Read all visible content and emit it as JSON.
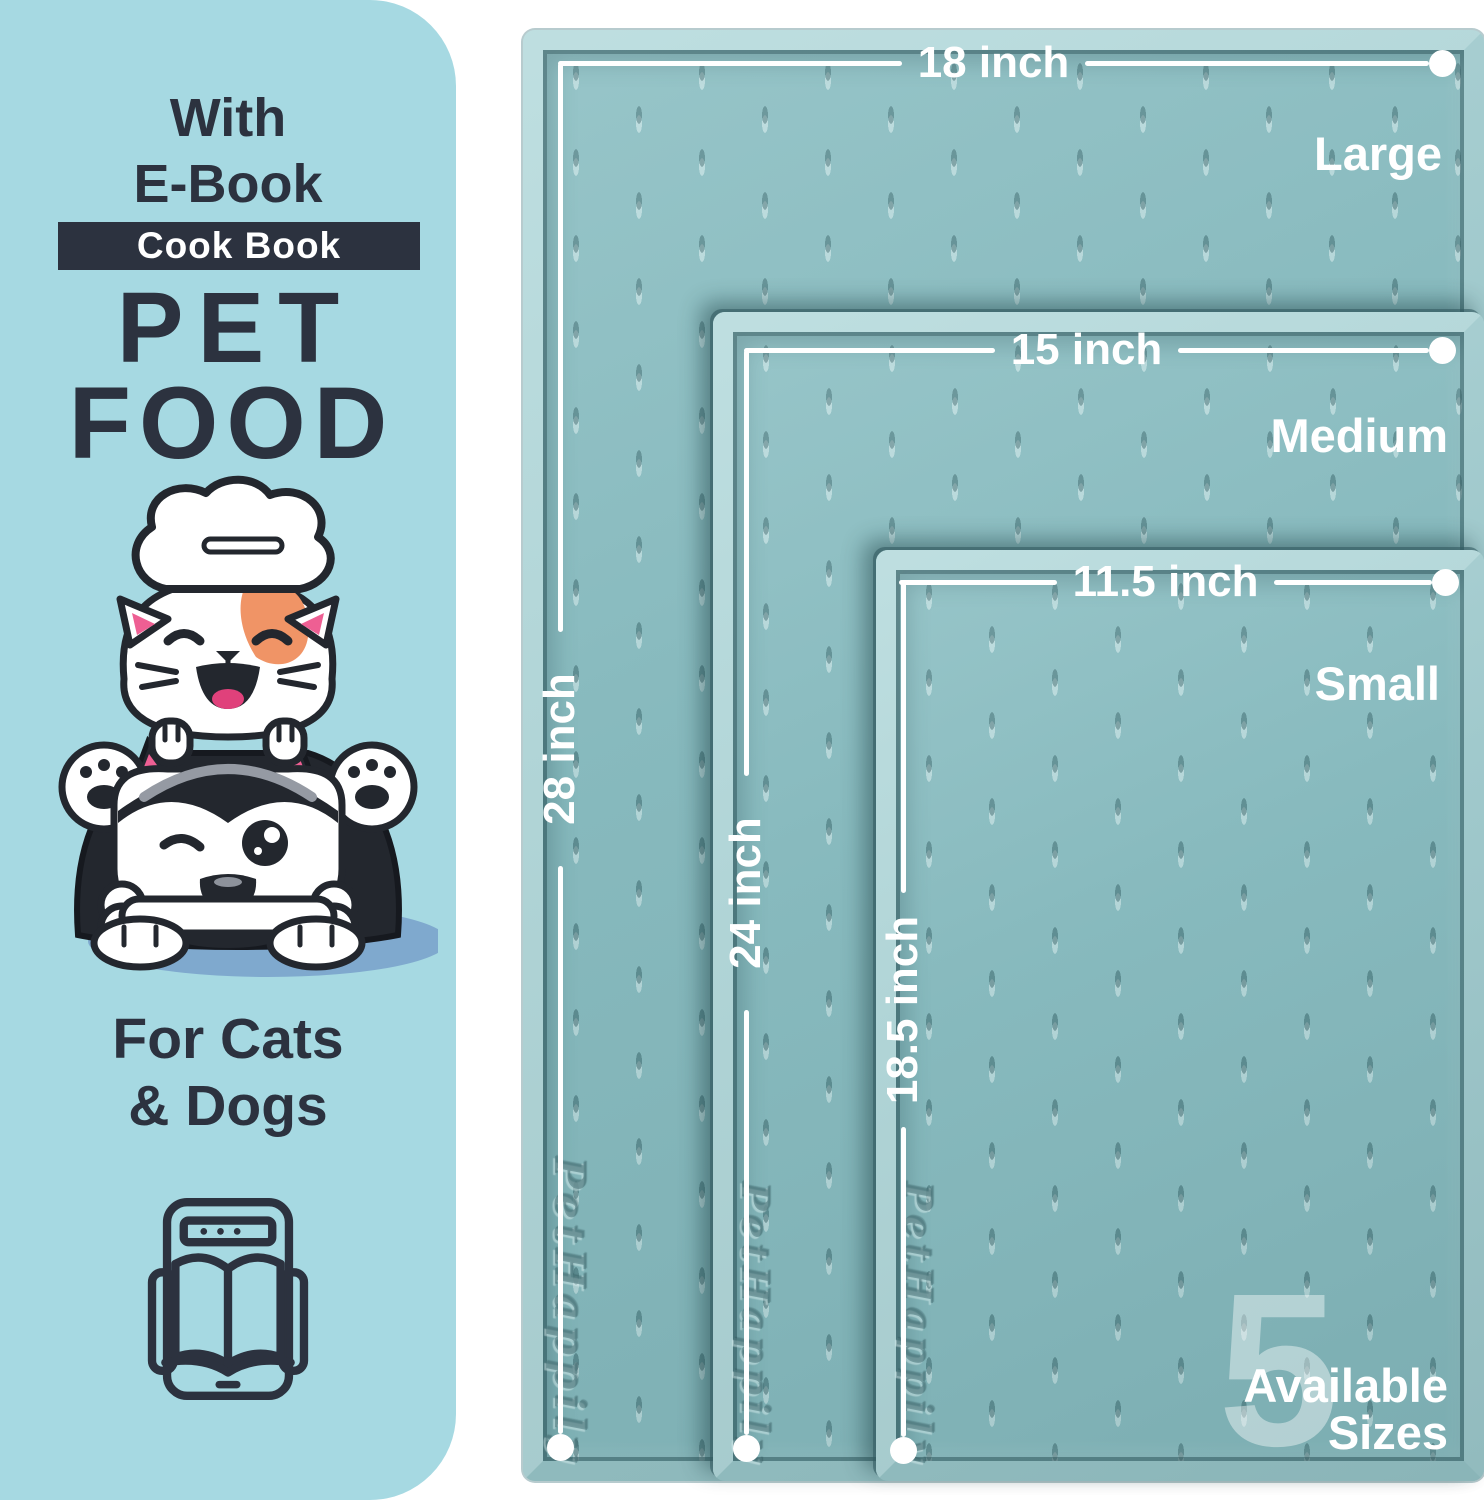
{
  "panel": {
    "subtitle_line1": "With",
    "subtitle_line2": "E-Book",
    "badge": "Cook Book",
    "title_line1": "PET",
    "title_line2": "FOOD",
    "audience_line1": "For Cats",
    "audience_line2": "& Dogs"
  },
  "mats": [
    {
      "name": "Large",
      "width_label": "18 inch",
      "height_label": "28 inch"
    },
    {
      "name": "Medium",
      "width_label": "15 inch",
      "height_label": "24 inch"
    },
    {
      "name": "Small",
      "width_label": "11.5 inch",
      "height_label": "18.5 inch"
    }
  ],
  "brand_emboss": "PetHappily",
  "sizes_badge": {
    "count": "5",
    "line1": "Available",
    "line2": "Sizes"
  },
  "colors": {
    "panel_bg": "#a6d9e2",
    "ink": "#2c323f",
    "mat_teal": "#8cbfc3",
    "mat_rim": "#b7dbdd",
    "measure_white": "#ffffff",
    "orange_patch": "#f09466",
    "pink": "#ee5f93"
  }
}
